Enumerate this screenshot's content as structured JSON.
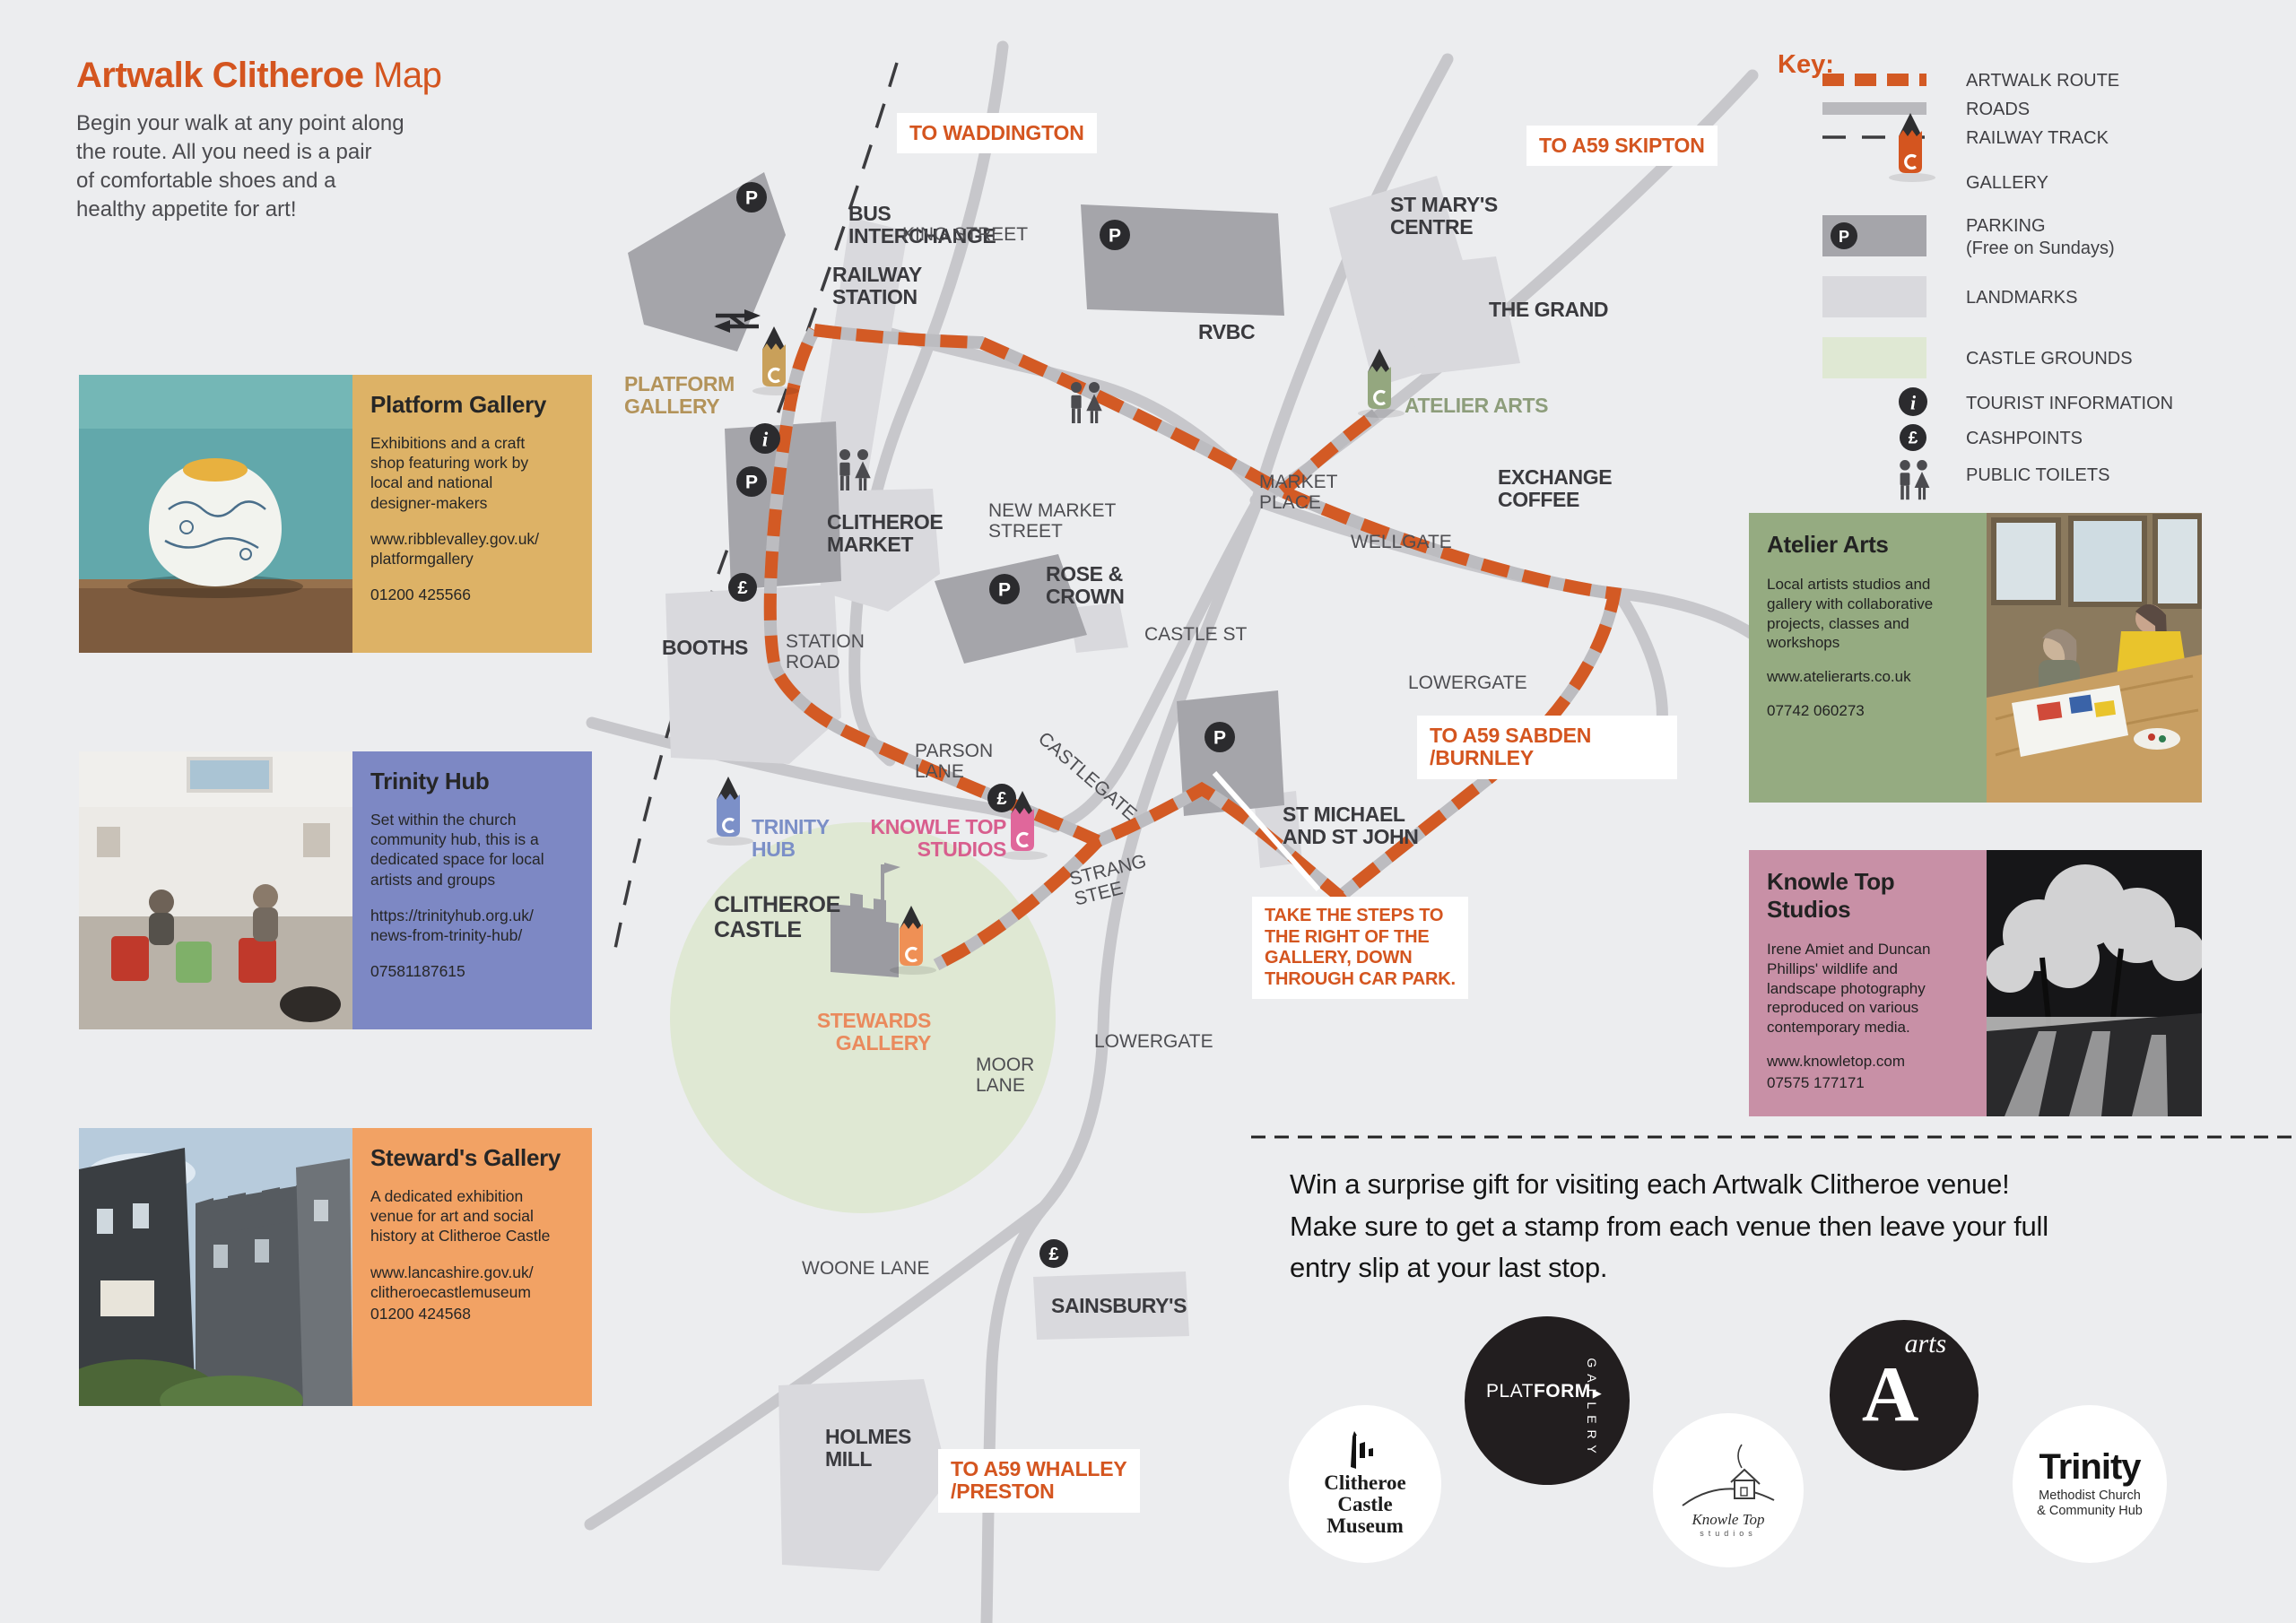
{
  "header": {
    "title_bold": "Artwalk Clitheroe",
    "title_light": " Map",
    "intro": "Begin your walk at any point along\nthe route. All you need is a pair\nof comfortable shoes and a\nhealthy appetite for art!"
  },
  "cards": {
    "platform": {
      "title": "Platform Gallery",
      "desc": "Exhibitions and a craft\nshop featuring work by\nlocal and national\ndesigner-makers",
      "web": "www.ribblevalley.gov.uk/\nplatformgallery",
      "phone": "01200 425566",
      "color": "#ddb266"
    },
    "trinity": {
      "title": "Trinity Hub",
      "desc": "Set within the church\ncommunity hub, this is a\ndedicated space for local\nartists and groups",
      "web": "https://trinityhub.org.uk/\nnews-from-trinity-hub/",
      "phone": "07581187615",
      "color": "#7d88c4"
    },
    "stewards": {
      "title": "Steward's Gallery",
      "desc": "A dedicated exhibition\nvenue for art and social\nhistory at Clitheroe Castle",
      "web": "www.lancashire.gov.uk/\nclitheroecastlemuseum",
      "phone": "01200 424568",
      "color": "#f2a264"
    },
    "atelier": {
      "title": "Atelier Arts",
      "desc": "Local artists studios and\ngallery with collaborative\nprojects, classes and\nworkshops",
      "web": "www.atelierarts.co.uk",
      "phone": "07742 060273",
      "color": "#95ab81"
    },
    "knowle": {
      "title": "Knowle Top\nStudios",
      "desc": "Irene Amiet and Duncan\nPhillips' wildlife and\nlandscape photography\nreproduced on various\ncontemporary media.",
      "web": "www.knowletop.com",
      "phone": "07575 177171",
      "color": "#c890a6"
    }
  },
  "key": {
    "title": "Key:",
    "items": [
      {
        "label": "ARTWALK ROUTE"
      },
      {
        "label": "ROADS"
      },
      {
        "label": "RAILWAY TRACK"
      },
      {
        "label": "GALLERY"
      },
      {
        "label": "PARKING\n(Free on Sundays)"
      },
      {
        "label": "LANDMARKS"
      },
      {
        "label": "CASTLE GROUNDS"
      },
      {
        "label": "TOURIST INFORMATION"
      },
      {
        "label": "CASHPOINTS"
      },
      {
        "label": "PUBLIC TOILETS"
      }
    ]
  },
  "map": {
    "labels": [
      {
        "text": "TO WADDINGTON"
      },
      {
        "text": "TO A59 SKIPTON"
      },
      {
        "text": "BUS\nINTERCHANGE"
      },
      {
        "text": "RAILWAY\nSTATION"
      },
      {
        "text": "PLATFORM\nGALLERY"
      },
      {
        "text": "KING STREET"
      },
      {
        "text": "ST MARY'S\nCENTRE"
      },
      {
        "text": "THE GRAND"
      },
      {
        "text": "RVBC"
      },
      {
        "text": "ATELIER ARTS"
      },
      {
        "text": "MARKET\nPLACE"
      },
      {
        "text": "EXCHANGE\nCOFFEE"
      },
      {
        "text": "WELLGATE"
      },
      {
        "text": "NEW MARKET\nSTREET"
      },
      {
        "text": "CLITHEROE\nMARKET"
      },
      {
        "text": "ROSE &\nCROWN"
      },
      {
        "text": "CASTLE ST"
      },
      {
        "text": "STATION\nROAD"
      },
      {
        "text": "BOOTHS"
      },
      {
        "text": "PARSON\nLANE"
      },
      {
        "text": "CASTLEGATE"
      },
      {
        "text": "LOWERGATE"
      },
      {
        "text": "TO A59 SABDEN\n/BURNLEY"
      },
      {
        "text": "ST MICHAEL\nAND ST JOHN"
      },
      {
        "text": "TAKE THE STEPS TO\nTHE RIGHT OF THE\nGALLERY, DOWN\nTHROUGH CAR PARK."
      },
      {
        "text": "TRINITY\nHUB"
      },
      {
        "text": "KNOWLE TOP\nSTUDIOS"
      },
      {
        "text": "CLITHEROE\nCASTLE"
      },
      {
        "text": "STEWARDS\nGALLERY"
      },
      {
        "text": "STRANG\nSTEE"
      },
      {
        "text": "MOOR\nLANE"
      },
      {
        "text": "LOWERGATE"
      },
      {
        "text": "WOONE LANE"
      },
      {
        "text": "SAINSBURY'S"
      },
      {
        "text": "HOLMES\nMILL"
      },
      {
        "text": "TO A59 WHALLEY\n/PRESTON"
      }
    ]
  },
  "promo": {
    "text": "Win a surprise gift for visiting each Artwalk Clitheroe venue!\nMake sure to get a stamp from each venue then leave your full\nentry slip at your last stop."
  },
  "logos": {
    "castle_museum": {
      "line1": "Clitheroe",
      "line2": "Castle",
      "line3": "Museum"
    },
    "platform": {
      "part1": "PLAT",
      "part2": "FORM",
      "tri": "▶",
      "vertical": "GALLERY"
    },
    "knowle": {
      "name": "Knowle Top",
      "sub": "studios"
    },
    "arts": {
      "a": "A",
      "word": "arts"
    },
    "trinity": {
      "name": "Trinity",
      "sub": "Methodist Church\n& Community Hub"
    }
  }
}
